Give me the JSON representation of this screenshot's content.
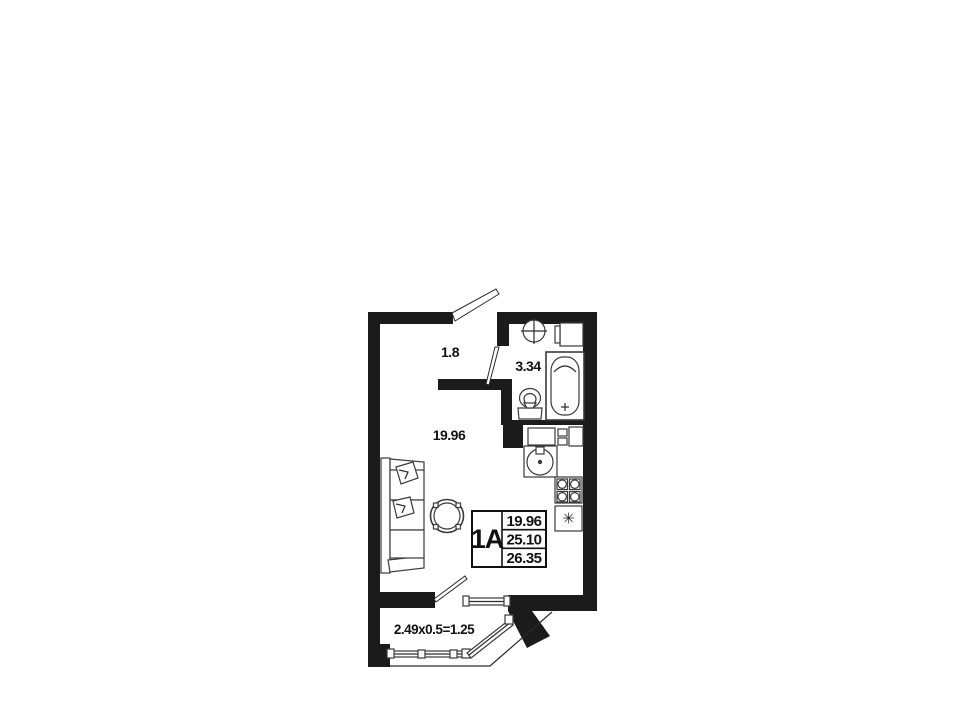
{
  "page": {
    "background": "#ffffff"
  },
  "plan": {
    "colors": {
      "wall": "#1b1b1b",
      "line": "#3a3a3a"
    },
    "rooms": {
      "hallway": {
        "area": "1.8"
      },
      "bathroom": {
        "area": "3.34"
      },
      "living": {
        "area": "19.96"
      },
      "balcony": {
        "dimensions": "2.49x0.5=1.25"
      }
    },
    "stamp": {
      "unit": "1A",
      "rows": [
        "19.96",
        "25.10",
        "26.35"
      ]
    },
    "fixtures": {
      "fridge_symbol": "✳"
    }
  }
}
